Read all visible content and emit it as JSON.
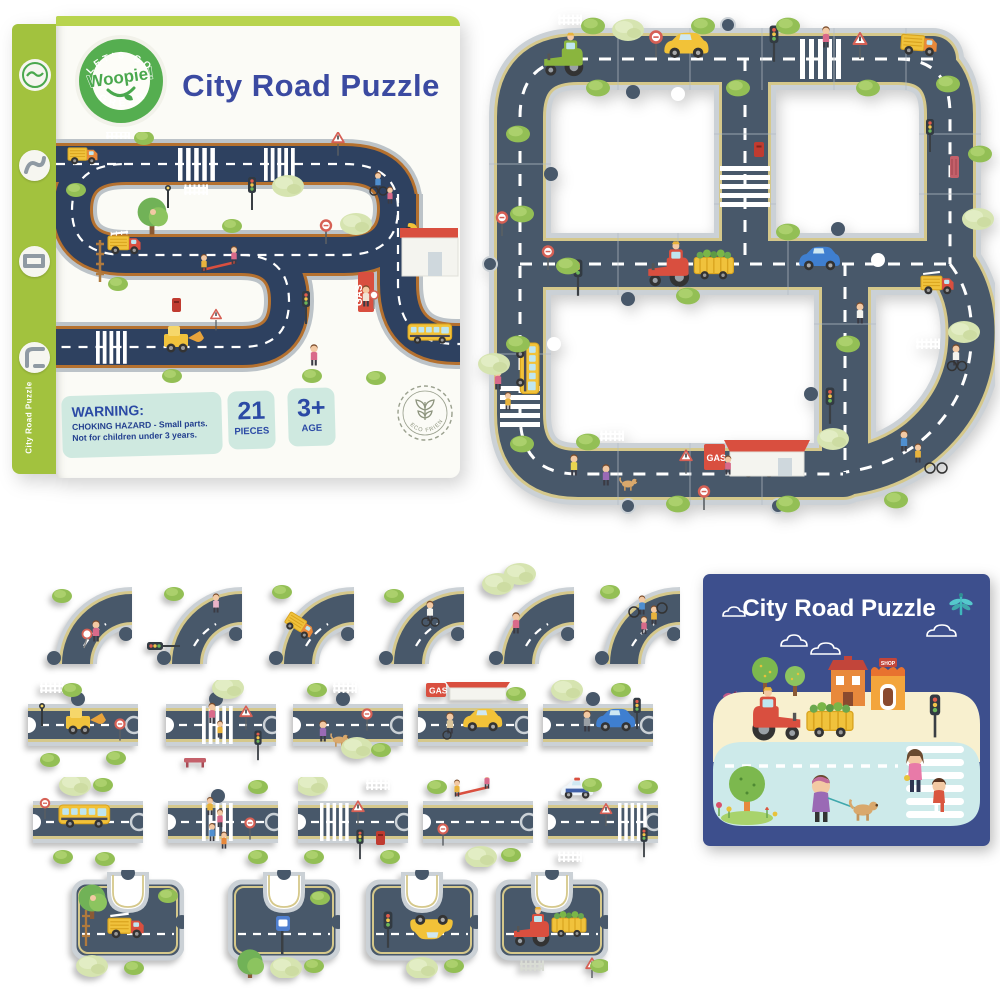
{
  "box": {
    "title": "City Road Puzzle",
    "logo": {
      "top_arc": "LET'S GO",
      "brand": "Woopie!",
      "bottom_arc": "GREEN"
    },
    "spine": {
      "vertical_label": "City Road Puzzle"
    },
    "warning": {
      "heading": "WARNING:",
      "line1": "CHOKING HAZARD - Small parts.",
      "line2": "Not for children under 3 years."
    },
    "badges": [
      {
        "value": "21",
        "label": "PIECES"
      },
      {
        "value": "3+",
        "label": "AGE"
      }
    ],
    "eco_badge": "ECO FRIENDLY",
    "art": {
      "gas_sign": "GAS"
    }
  },
  "assembled": {
    "gas_sign": "GAS"
  },
  "card": {
    "title": "City Road Puzzle",
    "shop_sign": "SHOP"
  },
  "pieces": {
    "row1": [
      {
        "type": "curve",
        "decor": "kid with crossing-guard sign"
      },
      {
        "type": "curve",
        "decor": "traffic light and child"
      },
      {
        "type": "curve",
        "decor": "orange truck"
      },
      {
        "type": "curve",
        "decor": "child on bicycle"
      },
      {
        "type": "curve",
        "decor": "girl with big trees"
      },
      {
        "type": "curve",
        "decor": "kids cycling group"
      }
    ],
    "row2": [
      {
        "type": "straight",
        "decor": "yellow digger, fence, lamp, stop sign"
      },
      {
        "type": "straight",
        "decor": "crosswalk, mom and kid, warning sign, traffic light, bench"
      },
      {
        "type": "straight",
        "decor": "girl walking dog, fence, hanging sign"
      },
      {
        "type": "straight",
        "decor": "gas station, yellow car, boy with bike",
        "label": "GAS"
      },
      {
        "type": "straight",
        "decor": "blue car with driver, traffic light"
      }
    ],
    "row3": [
      {
        "type": "straight",
        "decor": "yellow school bus, trees, stop sign"
      },
      {
        "type": "straight",
        "decor": "kids crossing crosswalk, stop sign"
      },
      {
        "type": "straight",
        "decor": "crosswalk, warning sign, traffic light, red postbox"
      },
      {
        "type": "straight",
        "decor": "kids on seesaw, stop sign, bushes"
      },
      {
        "type": "straight",
        "decor": "police car, crosswalk, warning sign, traffic light"
      }
    ],
    "row4": [
      {
        "type": "junction",
        "decor": "fire truck, ladder, kid in tree"
      },
      {
        "type": "junction",
        "decor": "bus stop sign and trees"
      },
      {
        "type": "junction",
        "decor": "yellow taxi and traffic light"
      },
      {
        "type": "junction",
        "decor": "red tractor with vegetable trailer, fence, warning sign"
      }
    ]
  },
  "colors": {
    "box_green": "#a2c23e",
    "title_navy": "#3b4aa1",
    "mint_panel": "#cfe9e0",
    "road_asphalt": "#48586a",
    "road_curb": "#cbd1d6",
    "road_lane_line": "#d5c88b",
    "box_road_asphalt": "#2e4160",
    "box_road_line": "#b5712f",
    "card_blue": "#3d4f8d",
    "card_cream": "#f8f0cf",
    "card_teal": "#cdeaea"
  }
}
